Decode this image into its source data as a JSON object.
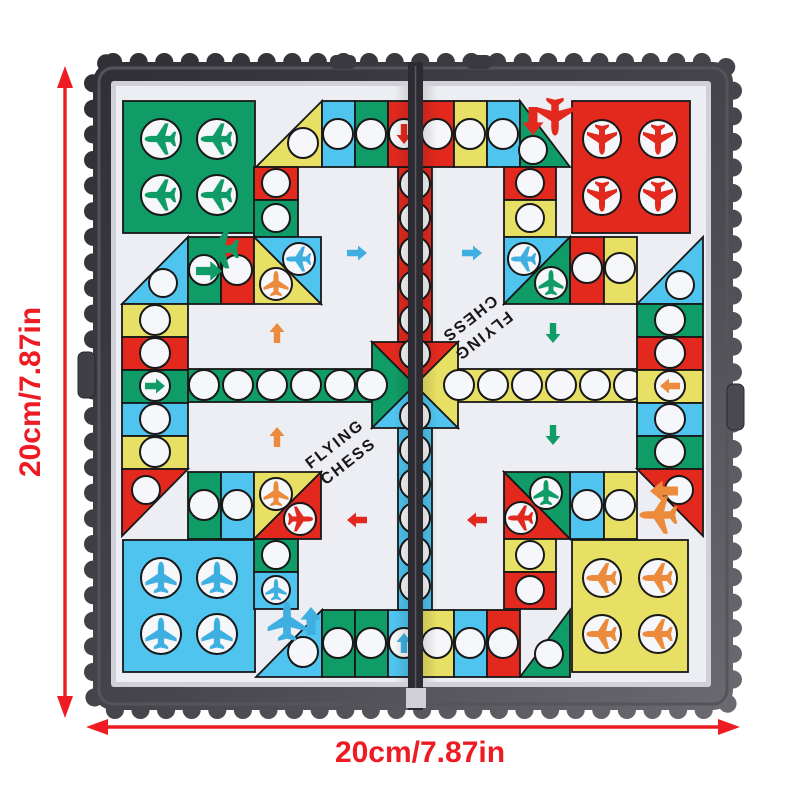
{
  "product_photo": {
    "subject": "Foldable magnetic Flying Chess (aeroplane chess) game board, product photo with size annotations",
    "board_title_line1": "FLYING",
    "board_title_line2": "CHESS",
    "board_title_instances": 2,
    "dimension_width_label": "20cm/7.87in",
    "dimension_height_label": "20cm/7.87in",
    "colors": {
      "green": "#109c66",
      "red": "#e3291e",
      "blue": "#4ec4ef",
      "yellow": "#e8e064",
      "orange": "#ec8b3c",
      "plane_blue": "#3fafe2",
      "frame_dark": "#36353b",
      "sheet_white": "#edeef3",
      "dimension_red": "#ee1c22",
      "title_text": "#161616"
    },
    "hangars": [
      {
        "position": "top-left",
        "color": "green",
        "planes": 4
      },
      {
        "position": "top-right",
        "color": "red",
        "planes": 4
      },
      {
        "position": "bottom-left",
        "color": "blue",
        "planes": 4
      },
      {
        "position": "bottom-right",
        "color": "yellow",
        "planes": 4
      }
    ],
    "board": {
      "fold": "two halves joined by a center vertical hinge seam",
      "frame_edge": "scalloped dark plastic frame",
      "center": "four-color cross of arrows (red top, green left, yellow right, blue bottom) meeting at center",
      "track": "colored cells with white circular spots"
    }
  }
}
